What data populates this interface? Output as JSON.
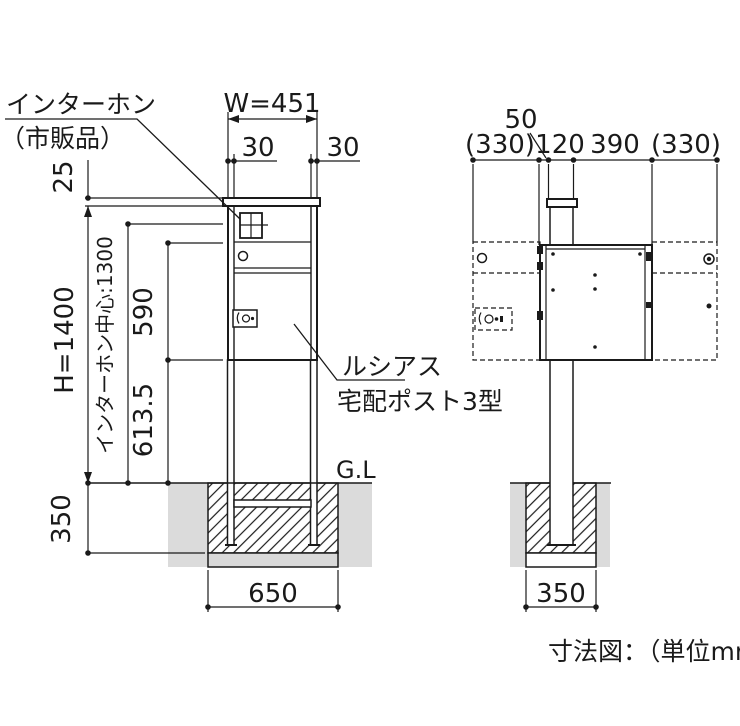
{
  "page": {
    "caption": "寸法図：（単位mm）"
  },
  "annotations": {
    "intercom_label_1": "インターホン",
    "intercom_label_2": "（市販品）",
    "product_label_1": "ルシアス",
    "product_label_2": "宅配ポスト3型",
    "ground_label": "G.L"
  },
  "front": {
    "dims": {
      "overall_width": "W=451",
      "post_face_left": "30",
      "post_face_right": "30",
      "cap_offset": "25",
      "overall_height": "H=1400",
      "intercom_center": "インターホン中心:1300",
      "box_height": "590",
      "underbox_clearance": "613.5",
      "embed_depth": "350",
      "footing_width": "650"
    }
  },
  "side": {
    "dims": {
      "front_offset": "50",
      "door_swing_front": "(330)",
      "post_depth": "120",
      "box_depth": "390",
      "door_swing_back": "(330)",
      "footing_width": "350"
    }
  },
  "colors": {
    "line": "#1a1a1a",
    "soil": "#dbdbdb"
  }
}
